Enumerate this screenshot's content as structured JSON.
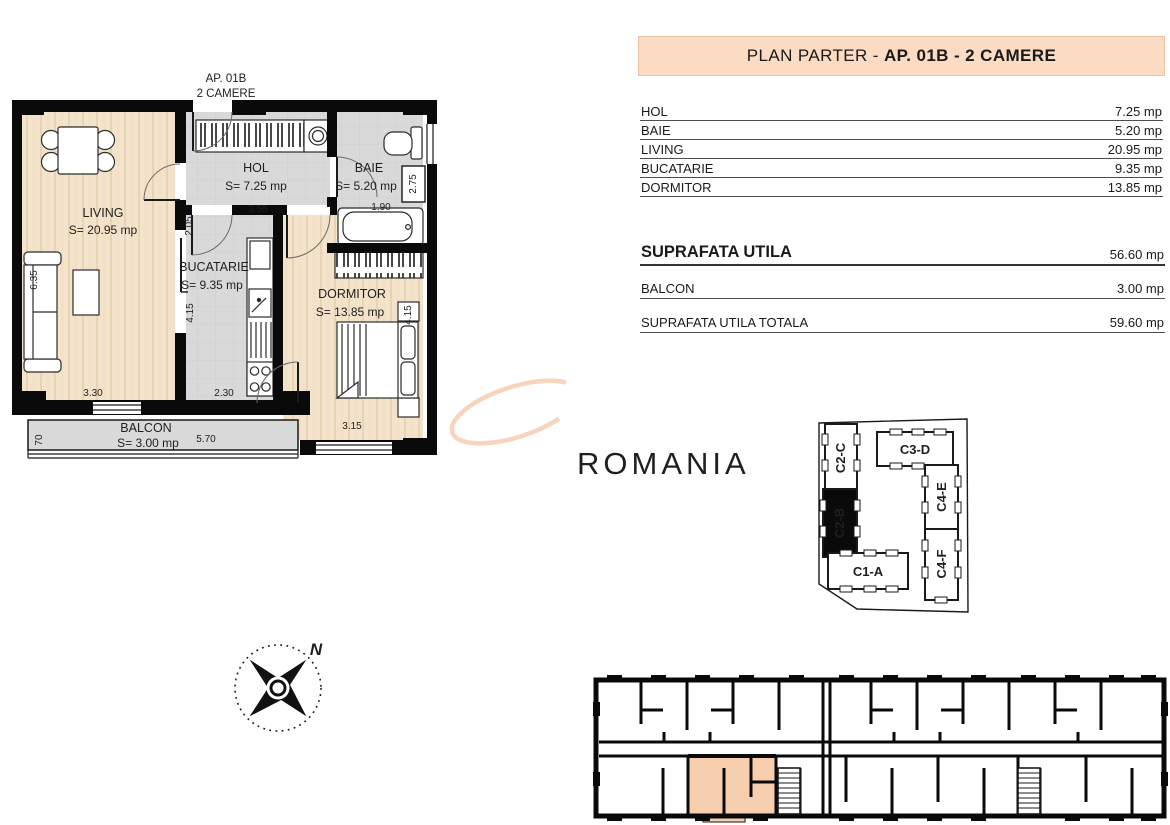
{
  "header": {
    "title_prefix": "PLAN PARTER - ",
    "title_bold": "AP. 01B - 2 CAMERE"
  },
  "plan_label": {
    "line1": "AP. 01B",
    "line2": "2 CAMERE"
  },
  "rooms_table": {
    "rows": [
      {
        "name": "HOL",
        "area": "7.25 mp"
      },
      {
        "name": "BAIE",
        "area": "5.20 mp"
      },
      {
        "name": "LIVING",
        "area": "20.95 mp"
      },
      {
        "name": "BUCATARIE",
        "area": "9.35 mp"
      },
      {
        "name": "DORMITOR",
        "area": "13.85 mp"
      }
    ]
  },
  "totals": {
    "suprafata_utila": {
      "label": "SUPRAFATA UTILA",
      "value": "56.60 mp"
    },
    "balcon": {
      "label": "BALCON",
      "value": "3.00 mp"
    },
    "suprafata_utila_totala": {
      "label": "SUPRAFATA UTILA TOTALA",
      "value": "59.60 mp"
    }
  },
  "floorplan": {
    "rooms": {
      "living": {
        "name": "LIVING",
        "area": "S= 20.95 mp"
      },
      "hol": {
        "name": "HOL",
        "area": "S= 7.25 mp"
      },
      "baie": {
        "name": "BAIE",
        "area": "S= 5.20 mp"
      },
      "bucatarie": {
        "name": "BUCATARIE",
        "area": "S= 9.35 mp"
      },
      "dormitor": {
        "name": "DORMITOR",
        "area": "S= 13.85 mp"
      },
      "balcon": {
        "name": "BALCON",
        "area": "S= 3.00 mp"
      }
    },
    "dims": {
      "hol_h": "2.05",
      "hol_w": "3.55",
      "baie_w": "1.90",
      "baie_h": "2.75",
      "living_h": "6.35",
      "living_w": "3.30",
      "buc_h": "4.15",
      "buc_w": "2.30",
      "dorm_h": "4.15",
      "dorm_w": "3.15",
      "balcon_w": "5.70",
      "balcon_h": "70"
    }
  },
  "site_plan": {
    "units": [
      {
        "id": "C2-C"
      },
      {
        "id": "C3-D"
      },
      {
        "id": "C4-E"
      },
      {
        "id": "C2-B"
      },
      {
        "id": "C1-A"
      },
      {
        "id": "C4-F"
      }
    ],
    "highlighted_unit": "C2-B"
  },
  "compass": {
    "north_label": "N"
  },
  "watermark": {
    "text": "ROMANIA"
  },
  "colors": {
    "accent_peach": "#fbdcc3",
    "highlight_unit": "#f7cfae",
    "wood_floor": "#f4e3cb",
    "tile_floor": "#d9d9d9",
    "watermark": "#f9d4bc",
    "wall": "#0a0a0a"
  }
}
